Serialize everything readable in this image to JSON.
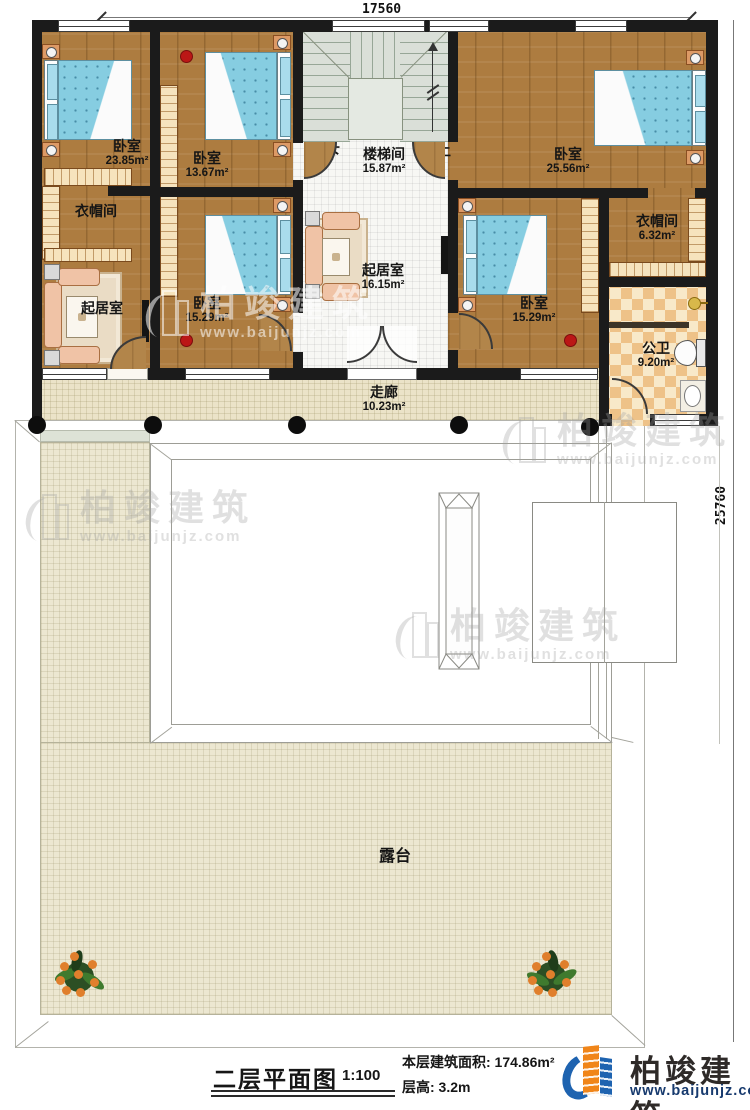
{
  "dimensions": {
    "width_top": "17560",
    "height_right": "25760"
  },
  "rooms": {
    "bedroom_tl": {
      "name": "卧室",
      "area": "23.85m²"
    },
    "bedroom_tm": {
      "name": "卧室",
      "area": "13.67m²"
    },
    "stairwell": {
      "name": "楼梯间",
      "area": "15.87m²"
    },
    "bedroom_tr": {
      "name": "卧室",
      "area": "25.56m²"
    },
    "cloakroom_left": {
      "name": "衣帽间"
    },
    "living_left": {
      "name": "起居室"
    },
    "bedroom_ml": {
      "name": "卧室",
      "area": "15.29m²"
    },
    "living_center": {
      "name": "起居室",
      "area": "16.15m²"
    },
    "bedroom_mr": {
      "name": "卧室",
      "area": "15.29m²"
    },
    "cloakroom_right": {
      "name": "衣帽间",
      "area": "6.32m²"
    },
    "bathroom": {
      "name": "公卫",
      "area": "9.20m²"
    },
    "corridor": {
      "name": "走廊",
      "area": "10.23m²"
    },
    "terrace": {
      "name": "露台"
    }
  },
  "stair_marks": {
    "down": "下",
    "up": "上"
  },
  "footer": {
    "drawing_title": "二层平面图",
    "scale": "1:100",
    "floor_area": "本层建筑面积: 174.86m²",
    "floor_height": "层高: 3.2m"
  },
  "brand": {
    "name": "柏竣建筑",
    "website": "www.baijunjz.com"
  },
  "watermark": {
    "name": "柏竣建筑",
    "website": "www.baijunjz.com"
  },
  "colors": {
    "accent_orange": "#f08519",
    "accent_blue": "#1e63b0",
    "wall": "#1b1b1b",
    "wood": "#ad7c40"
  }
}
